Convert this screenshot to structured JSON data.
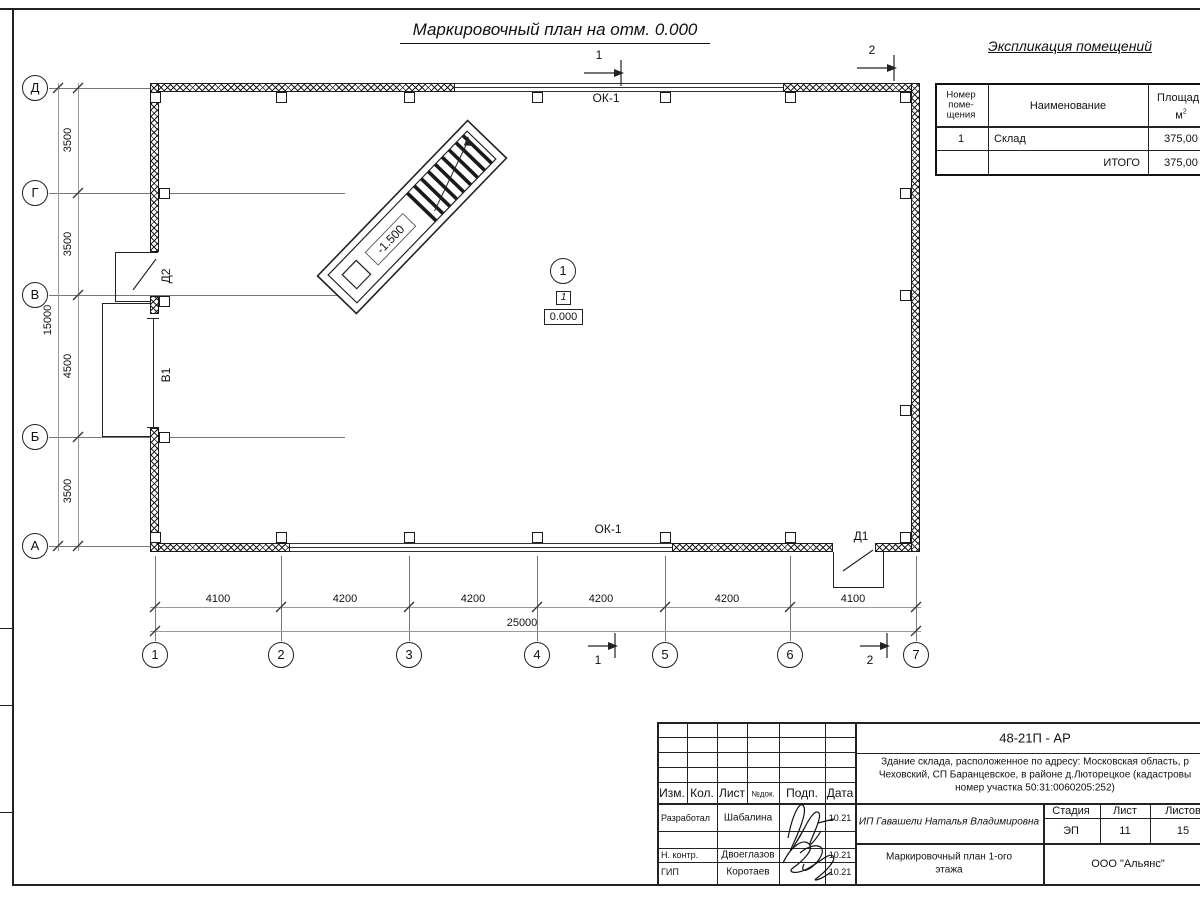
{
  "title": "Маркировочный план на отм. 0.000",
  "explication": {
    "title": "Экспликация помещений",
    "col_num_l1": "Номер",
    "col_num_l2": "поме-",
    "col_num_l3": "щения",
    "col_name": "Наименование",
    "col_area_l1": "Площадь",
    "col_area_unit": "м",
    "col_area_sup": "2",
    "row": {
      "num": "1",
      "name": "Склад",
      "area": "375,00"
    },
    "total_label": "ИТОГО",
    "total_area": "375,00"
  },
  "plan": {
    "axes_left": [
      "Д",
      "Г",
      "В",
      "Б",
      "А"
    ],
    "axes_bottom": [
      "1",
      "2",
      "3",
      "4",
      "5",
      "6",
      "7"
    ],
    "dims_left": [
      "3500",
      "3500",
      "4500",
      "3500"
    ],
    "dim_left_total": "15000",
    "dims_bottom": [
      "4100",
      "4200",
      "4200",
      "4200",
      "4200",
      "4100"
    ],
    "dim_bottom_total": "25000",
    "window_label_top": "ОК-1",
    "window_label_bottom": "ОК-1",
    "door_d2": "Д2",
    "gate_v1": "В1",
    "door_d1": "Д1",
    "ramp_level": "-1.500",
    "room_number": "1",
    "room_tag": "1",
    "floor_level": "0.000",
    "section1": "1",
    "section2": "2"
  },
  "titleblock": {
    "code": "48-21П - АР",
    "desc1": "Здание склада, расположенное по адресу: Московская область, р",
    "desc2": "Чеховский, СП Баранцевское, в районе д.Люторецкое (кадастровы",
    "desc3": "номер участка 50:31:0060205:252)",
    "cols": {
      "izm": "Изм.",
      "kol": "Кол.",
      "list": "Лист",
      "ndok": "№док.",
      "podp": "Подп.",
      "data": "Дата"
    },
    "rows": [
      {
        "role": "Разработал",
        "name": "Шабалина",
        "date": "10.21"
      },
      {
        "role": "Н. контр.",
        "name": "Двоеглазов",
        "date": "10.21"
      },
      {
        "role": "ГИП",
        "name": "Коротаев",
        "date": "10.21"
      }
    ],
    "client": "ИП Гавашели Наталья Владимировна",
    "stage_label": "Стадия",
    "sheet_label": "Лист",
    "sheets_label": "Листов",
    "stage": "ЭП",
    "sheet": "11",
    "sheets": "15",
    "drawing_name1": "Маркировочный план 1-ого",
    "drawing_name2": "этажа",
    "company": "ООО \"Альянс\""
  }
}
